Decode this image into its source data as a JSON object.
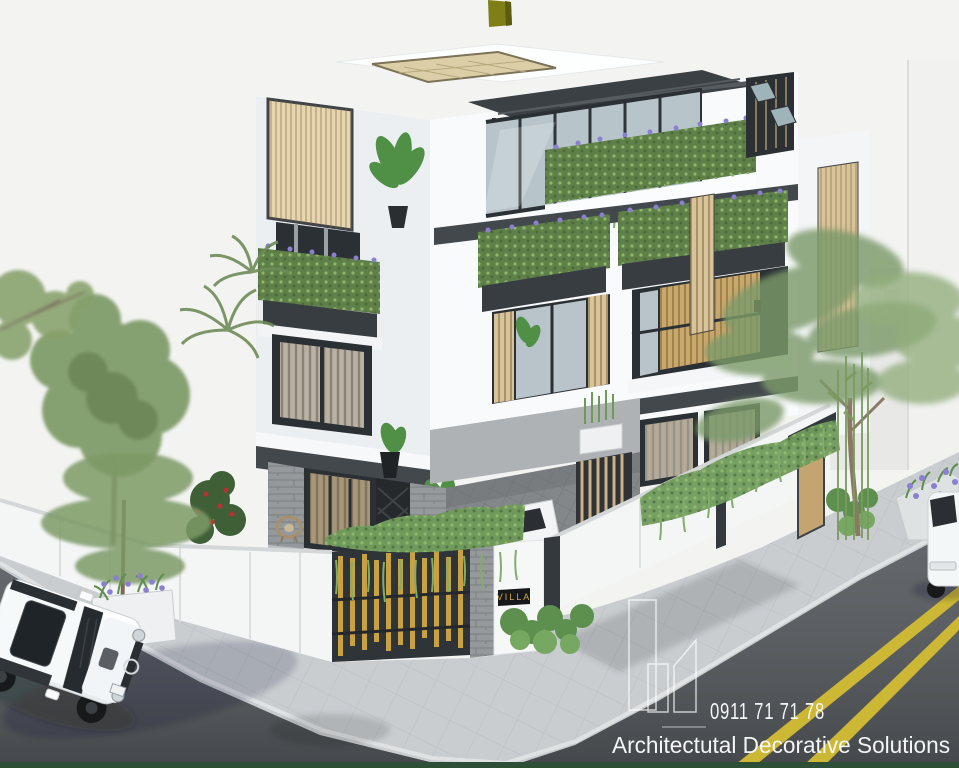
{
  "watermark": {
    "phone": "0911 71 71 78",
    "company": "Architectutal Decorative Solutions",
    "logo": "buildings-outline-icon"
  },
  "gate": {
    "plaque_text": "VILLA"
  },
  "palette": {
    "background": "#f3f4f2",
    "road": "#53575b",
    "sidewalk": "#c9cdd0",
    "lane_yellow": "#cdb835",
    "wall_white": "#f4f6f6",
    "building_white": "#f8fafb",
    "building_shaded": "#eceff1",
    "accent_dark": "#43484d",
    "frame_dark": "#2b3034",
    "wood_tan": "#d8c49a",
    "louver_beige": "#e6d6b0",
    "gate_gold": "#c8a140",
    "foliage_green": "#5f8049",
    "vine_green": "#7fae6d",
    "tree_green": "#7d9a66",
    "flower_purple": "#8a7fd0",
    "flower_red": "#b13430",
    "stone_gray": "#95999b",
    "sign_black": "#17181a",
    "sign_gold": "#cfa84e",
    "watermark_white": "#f4f5f6",
    "bottom_strip_green": "#2c4f36",
    "suv_white": "#f6f9fa",
    "flag_olive": "#7f7f17",
    "glass_blue": "#b7c4ca",
    "driveway_gray": "#83878a"
  }
}
